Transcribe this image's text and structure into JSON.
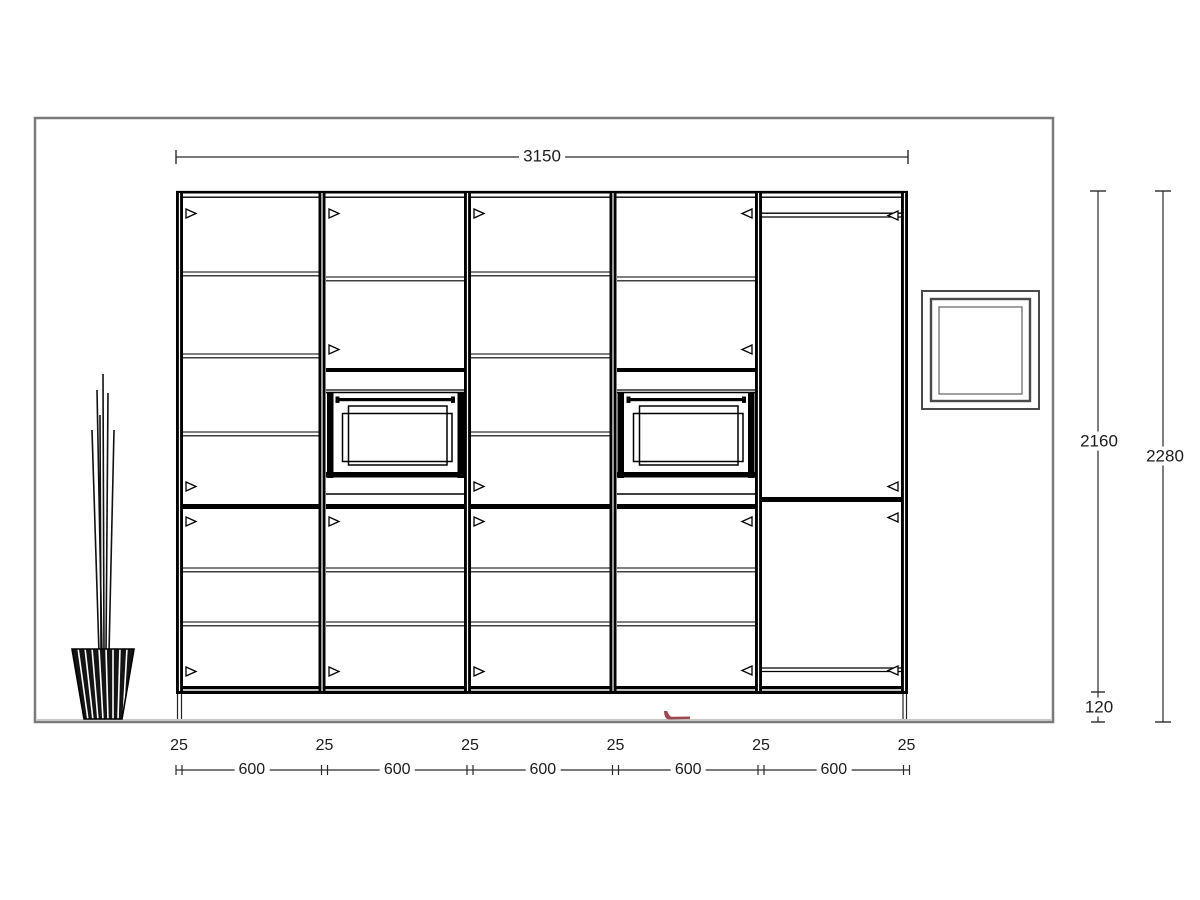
{
  "drawing": {
    "title": "kitchen-tall-cabinet-elevation",
    "dimensions": {
      "total_width": "3150",
      "cabinet_height": "2160",
      "total_height": "2280",
      "plinth_height": "120",
      "panel_widths": [
        "25",
        "25",
        "25",
        "25",
        "25",
        "25"
      ],
      "unit_widths": [
        "600",
        "600",
        "600",
        "600",
        "600"
      ]
    },
    "colors": {
      "line": "#000000",
      "dimension_line": "#2a2a2a",
      "wall_outline": "#7a7a7a",
      "floor_line": "#c8c8c8",
      "accent_mark": "#9c4952"
    }
  }
}
